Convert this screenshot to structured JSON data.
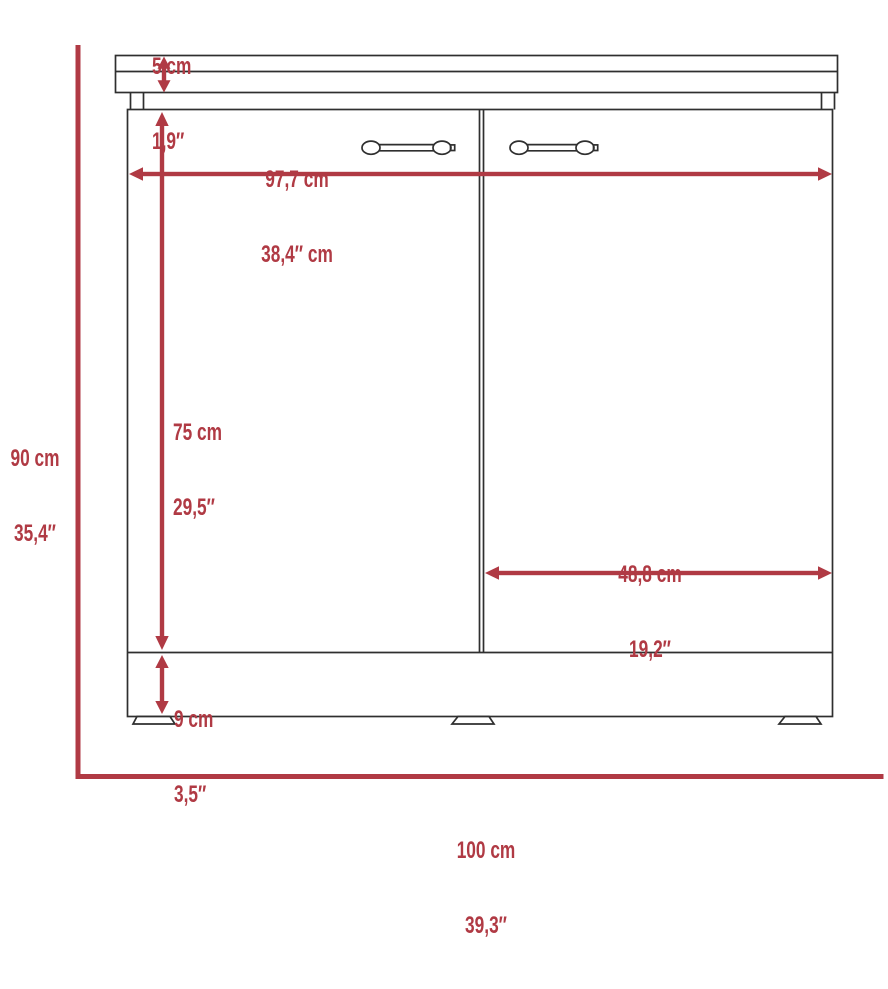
{
  "diagram": {
    "kind": "furniture-dimension-diagram",
    "subject": "two-door base cabinet with countertop, front elevation",
    "colors": {
      "dimension_red": "#b03a44",
      "outline_black": "#2f2f2f",
      "background": "#ffffff"
    },
    "labels": {
      "countertop_thickness": {
        "cm": "5 cm",
        "in": "1,9″"
      },
      "interior_width": {
        "cm": "97,7 cm",
        "in": "38,4″ cm"
      },
      "overall_height": {
        "cm": "90 cm",
        "in": "35,4″"
      },
      "door_height": {
        "cm": "75 cm",
        "in": "29,5″"
      },
      "door_width": {
        "cm": "48,8 cm",
        "in": "19,2″"
      },
      "base_height": {
        "cm": "9 cm",
        "in": "3,5″"
      },
      "overall_width": {
        "cm": "100 cm",
        "in": "39,3″"
      }
    }
  }
}
